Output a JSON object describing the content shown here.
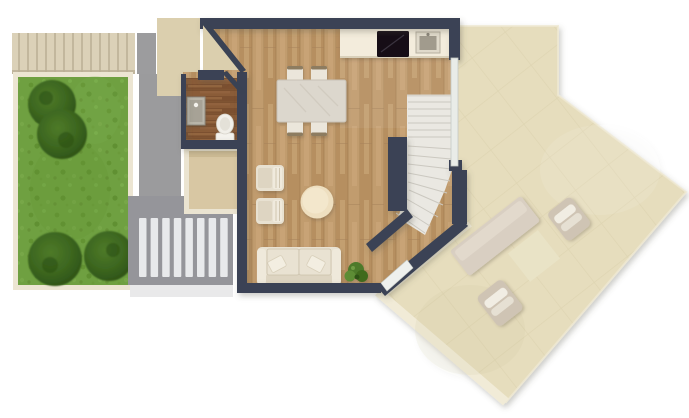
{
  "meta": {
    "title": "Floor plan",
    "description": "3D top-down architectural floor plan render with garden, living area, kitchen, bathroom, winder staircase and large terrace"
  },
  "palette": {
    "background": "#ffffff",
    "wall_navy": "#3a4254",
    "wood_floor": "#c09b6c",
    "wood_dark_bath": "#8a5c38",
    "grass_green": "#6fa041",
    "bush_green": "#3c661f",
    "path_gray": "#9b9b9d",
    "step_bar_light": "#e8e9eb",
    "cream_border": "#ece5d2",
    "entry_mat": "#dbcfae",
    "terrace_beige": "#e6ddbd",
    "terrace_edge": "#f1ebd7",
    "counter_white": "#f3ecdc",
    "cooktop_black": "#171115",
    "furniture_cream": "#e8e1d1",
    "stair_tread": "#eae8e2"
  },
  "scene": {
    "outdoor_left": [
      "garden-lawn",
      "garden-bushes",
      "hedge-strip",
      "concrete-path",
      "exterior-steps",
      "entry-mat"
    ],
    "interior": [
      "entry-door",
      "bathroom",
      "bathroom-sink",
      "toilet",
      "storage-room",
      "kitchen-counter",
      "cooktop",
      "kitchen-sink",
      "dining-table",
      "dining-chairs",
      "armchairs",
      "coffee-table",
      "sofa",
      "plant",
      "winder-staircase",
      "terrace-glass-door"
    ],
    "terrace": [
      "terrace-deck",
      "sun-platform",
      "outdoor-mat",
      "lounger-upper",
      "lounger-lower"
    ]
  }
}
